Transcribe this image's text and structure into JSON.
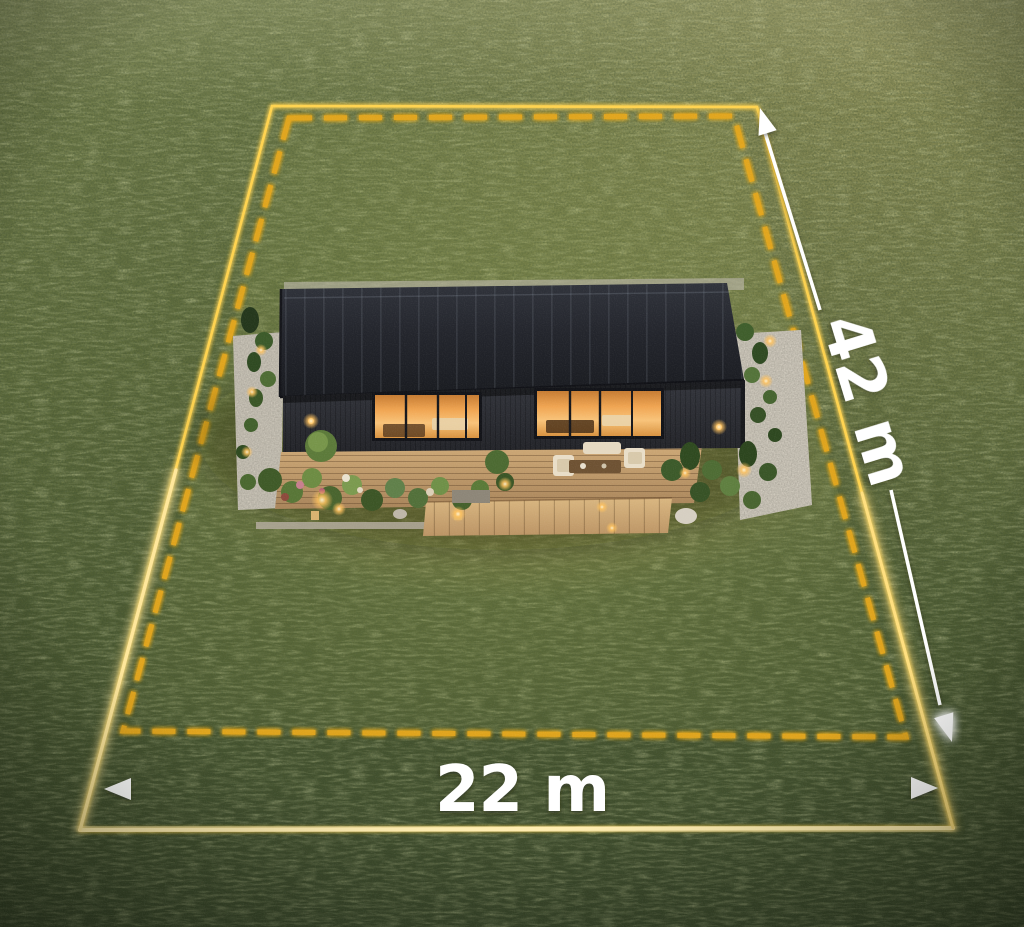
{
  "scene": {
    "dimensions": {
      "depth_label": "42 m",
      "width_label": "22 m"
    },
    "colors": {
      "boundary_solid": "#FFD75A",
      "boundary_glow": "#FFEDB0",
      "boundary_dashed": "#E8A81F",
      "dimension_line": "#FFFFFF",
      "grass_light": "#76814D",
      "grass_dark": "#39462A",
      "roof": "#23252C",
      "window_glow": "#F0A552",
      "deck_wood": "#C29C6B",
      "gravel": "#CDC7BA"
    }
  }
}
